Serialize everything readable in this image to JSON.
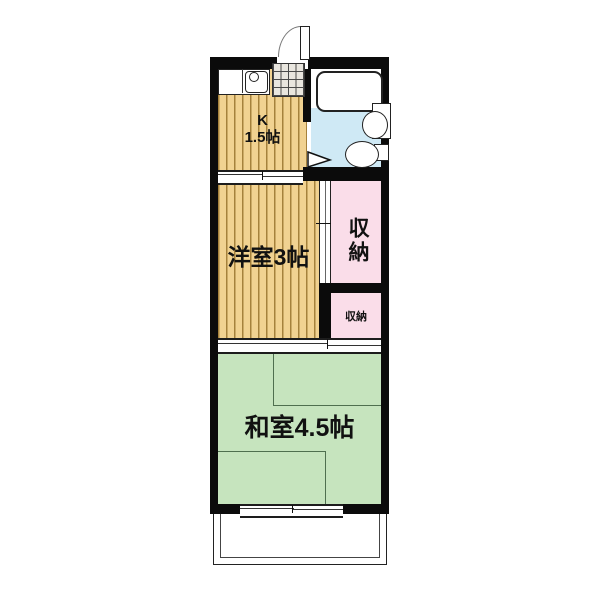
{
  "drawing": "apartment-floor-plan",
  "rooms": {
    "kitchen": {
      "label": "K",
      "size": "1.5帖"
    },
    "western_room": {
      "label": "洋室3帖"
    },
    "closet_upper": {
      "label": "収納"
    },
    "closet_lower": {
      "label": "収納"
    },
    "japanese_room": {
      "label": "和室4.5帖"
    }
  },
  "fixtures": [
    "entrance-door",
    "genkan-tiles",
    "kitchen-sink",
    "bathtub",
    "washbasin",
    "toilet",
    "sliding-door",
    "window",
    "balcony"
  ],
  "colors": {
    "wall": "#0b0b0b",
    "wood": "#f1d291",
    "wood-line": "#a5813c",
    "pink": "#fadde9",
    "blue": "#cfe9f5",
    "green": "#c6e4be",
    "green-line": "#4f6f4f",
    "tile": "#e9e6df",
    "tile-line": "#4a4a4a"
  }
}
